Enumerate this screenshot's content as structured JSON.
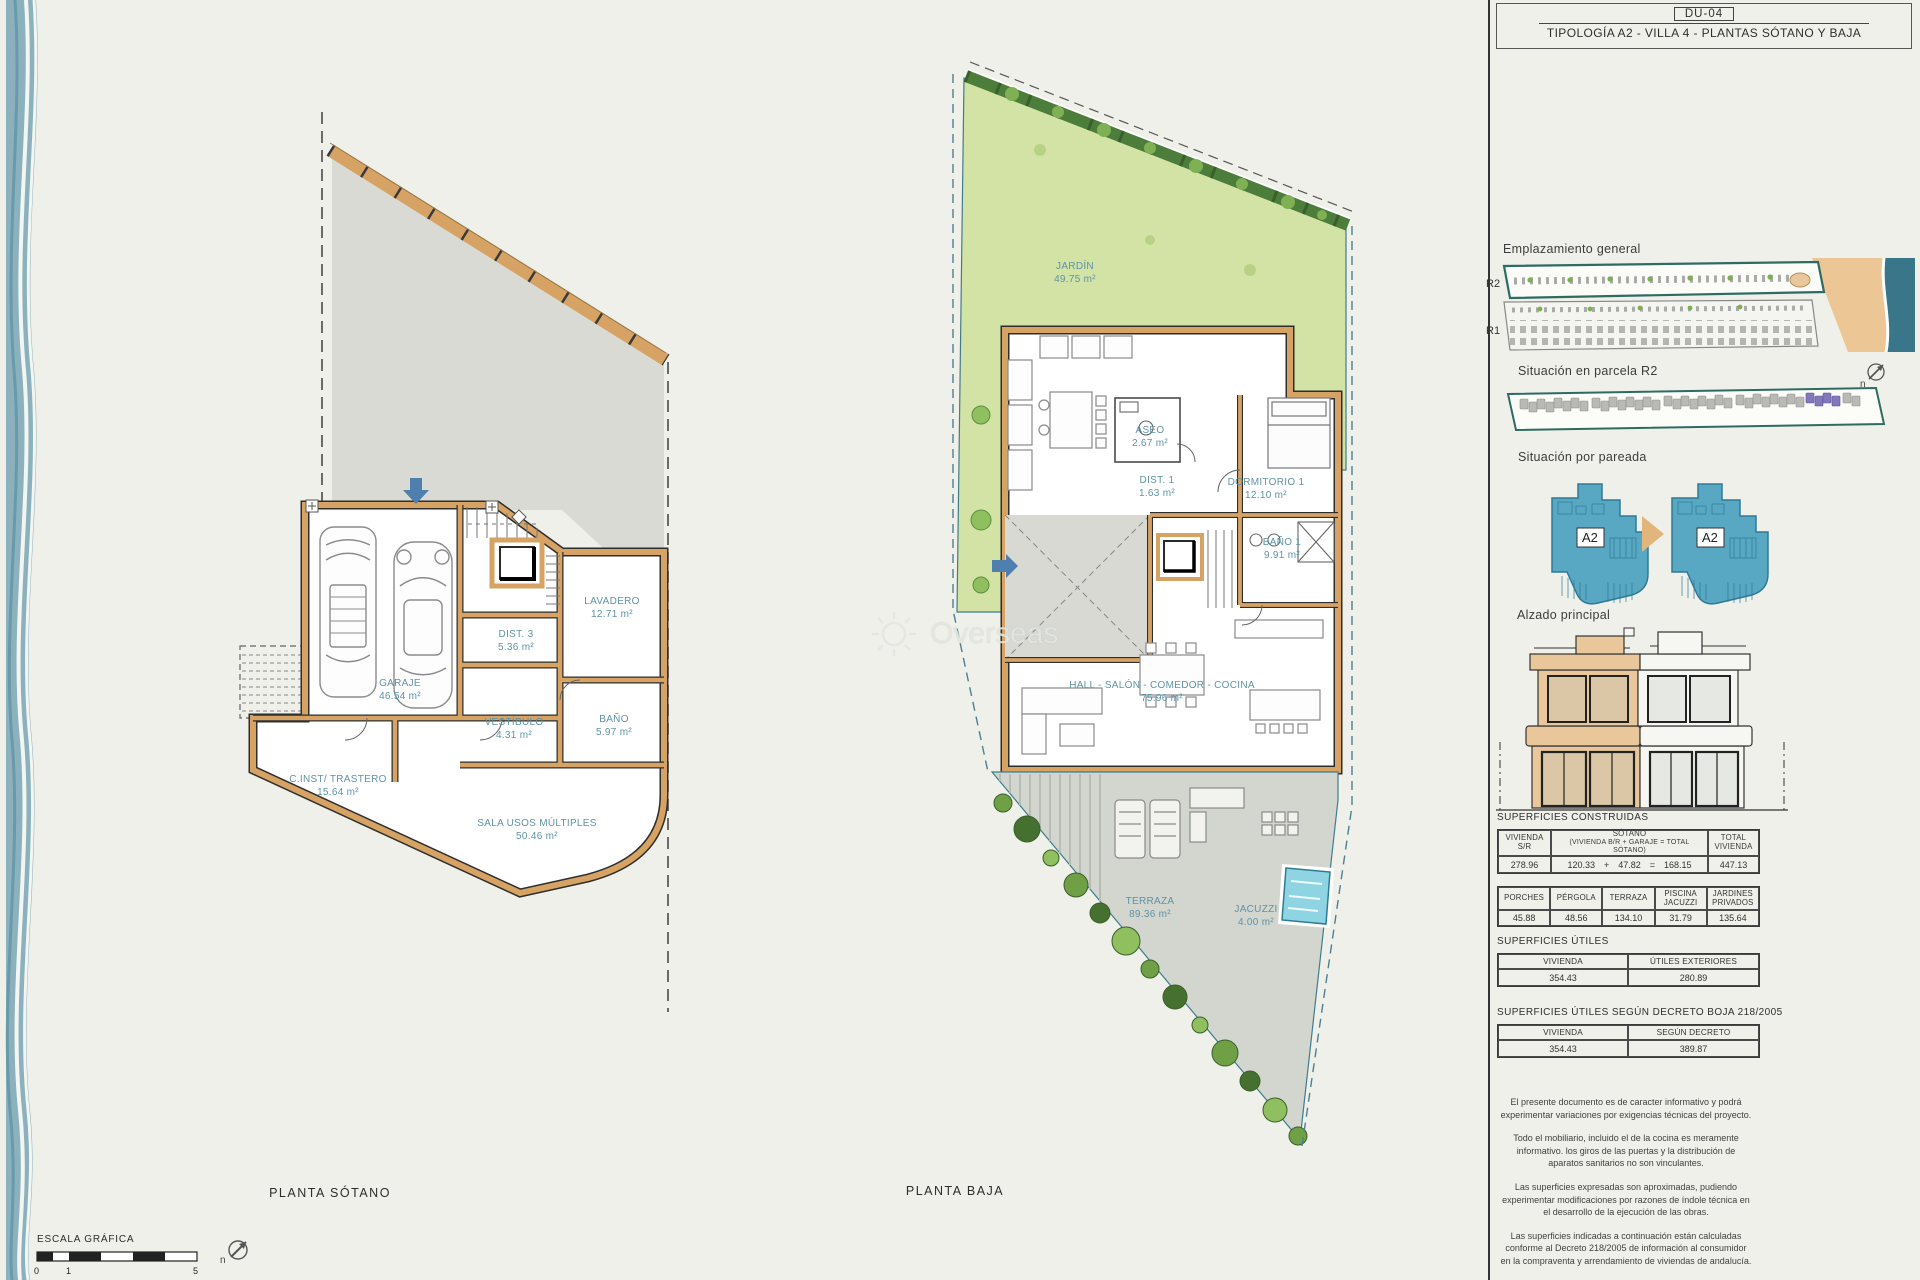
{
  "title_block": {
    "code": "DU-04",
    "subtitle": "TIPOLOGÍA A2 - VILLA 4 - PLANTAS SÓTANO Y BAJA"
  },
  "watermark": {
    "brand": "Overseas"
  },
  "north_letter": "n",
  "plans": {
    "sotano": {
      "caption": "PLANTA SÓTANO",
      "rooms": [
        {
          "name": "GARAJE",
          "area": "46.54 m²"
        },
        {
          "name": "LAVADERO",
          "area": "12.71 m²"
        },
        {
          "name": "DIST. 3",
          "area": "5.36 m²"
        },
        {
          "name": "VESTÍBULO",
          "area": "4.31 m²"
        },
        {
          "name": "BAÑO",
          "area": "5.97 m²"
        },
        {
          "name": "C.INST/ TRASTERO",
          "area": "15.64 m²"
        },
        {
          "name": "SALA USOS MÚLTIPLES",
          "area": "50.46 m²"
        }
      ]
    },
    "baja": {
      "caption": "PLANTA BAJA",
      "rooms": [
        {
          "name": "JARDÍN",
          "area": "49.75 m²"
        },
        {
          "name": "ASEO",
          "area": "2.67 m²"
        },
        {
          "name": "DIST. 1",
          "area": "1.63 m²"
        },
        {
          "name": "DORMITORIO 1",
          "area": "12.10 m²"
        },
        {
          "name": "BAÑO 1",
          "area": "9.91 m²"
        },
        {
          "name": "HALL - SALÓN - COMEDOR - COCINA",
          "area": "75.96 m²"
        },
        {
          "name": "TERRAZA",
          "area": "89.36 m²"
        },
        {
          "name": "JACUZZI",
          "area": "4.00 m²"
        }
      ]
    }
  },
  "scale": {
    "label": "ESCALA GRÁFICA",
    "ticks": [
      "0",
      "1",
      "5"
    ]
  },
  "sidebar": {
    "emplazamiento": {
      "title": "Emplazamiento general",
      "row_top": "R2",
      "row_bottom": "R1"
    },
    "parcela": {
      "title": "Situación en parcela R2"
    },
    "pareada": {
      "title": "Situación por pareada",
      "unit_left": "A2",
      "unit_right": "A2"
    },
    "alzado": {
      "title": "Alzado principal"
    },
    "construidas": {
      "title": "SUPERFICIES CONSTRUIDAS",
      "t1": {
        "h1": "VIVIENDA S/R",
        "h2a": "SÓTANO",
        "h2b": "(VIVIENDA B/R + GARAJE = TOTAL SÓTANO)",
        "h3a": "TOTAL",
        "h3b": "VIVIENDA",
        "v1": "278.96",
        "v2": "120.33",
        "op_plus": "+",
        "v3": "47.82",
        "op_eq": "=",
        "v4": "168.15",
        "v5": "447.13"
      },
      "t2": {
        "headers": [
          "PORCHES",
          "PÉRGOLA",
          "TERRAZA",
          "PISCINA JACUZZI",
          "JARDINES PRIVADOS"
        ],
        "values": [
          "45.88",
          "48.56",
          "134.10",
          "31.79",
          "135.64"
        ]
      }
    },
    "utiles": {
      "title": "SUPERFICIES ÚTILES",
      "h1": "VIVIENDA",
      "h2": "ÚTILES EXTERIORES",
      "v1": "354.43",
      "v2": "280.89"
    },
    "decreto": {
      "title": "SUPERFICIES ÚTILES SEGÚN DECRETO BOJA 218/2005",
      "h1": "VIVIENDA",
      "h2": "SEGÚN DECRETO",
      "v1": "354.43",
      "v2": "389.87"
    },
    "notes": [
      "El presente documento es de caracter informativo y podrá experimentar variaciones por exigencias técnicas del proyecto.",
      "Todo el mobiliario, incluido el de la cocina es meramente informativo. los giros de las puertas y la distribución de aparatos sanitarios no son vinculantes.",
      "Las superficies expresadas son aproximadas, pudiendo experimentar modificaciones por razones de índole técnica en el desarrollo de la ejecución de las obras.",
      "Las superficies indicadas a continuación están calculadas conforme al Decreto 218/2005 de información al consumidor en la compraventa y arrendamiento de viviendas de andalucía."
    ]
  },
  "colors": {
    "wall_tan": "#d6a365",
    "garden_green": "#d2e3a5",
    "hedge_green": "#4d7d3a",
    "sea_teal": "#39768a",
    "sand": "#ecc795",
    "unit_blue": "#58a7c3",
    "pool_cyan": "#8fd4e2",
    "highlight_purple": "#8377bd",
    "arrow_blue": "#4f7fae",
    "arrow_tan": "#e2b57c",
    "label_teal": "#5e93a6"
  }
}
